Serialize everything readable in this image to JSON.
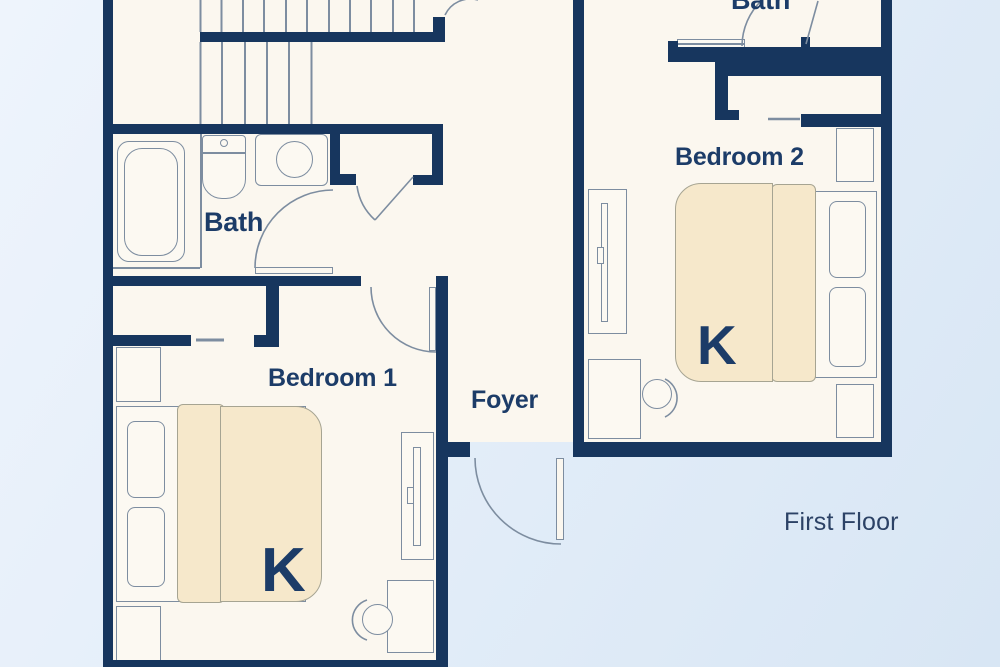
{
  "floor_plan": {
    "floor_label": "First Floor",
    "rooms": [
      {
        "id": "bath-upper",
        "label": "Bath"
      },
      {
        "id": "bath-main",
        "label": "Bath"
      },
      {
        "id": "bedroom-1",
        "label": "Bedroom 1",
        "bed_size": "K"
      },
      {
        "id": "bedroom-2",
        "label": "Bedroom 2",
        "bed_size": "K"
      },
      {
        "id": "foyer",
        "label": "Foyer"
      }
    ]
  },
  "labels": {
    "bath_upper": "Bath",
    "bath_main": "Bath",
    "bedroom1": "Bedroom 1",
    "bedroom2": "Bedroom 2",
    "foyer": "Foyer",
    "floor_name": "First Floor",
    "bed1_king": "K",
    "bed2_king": "K"
  },
  "colors": {
    "wall_navy": "#17365e",
    "text_navy": "#1c3c68",
    "floor_cream": "#fbf7ef",
    "bed_tan": "#f6e8cb",
    "outline_gray": "#7d8da0",
    "background_light": "#eef4fc",
    "background_dark": "#d8e6f4"
  }
}
